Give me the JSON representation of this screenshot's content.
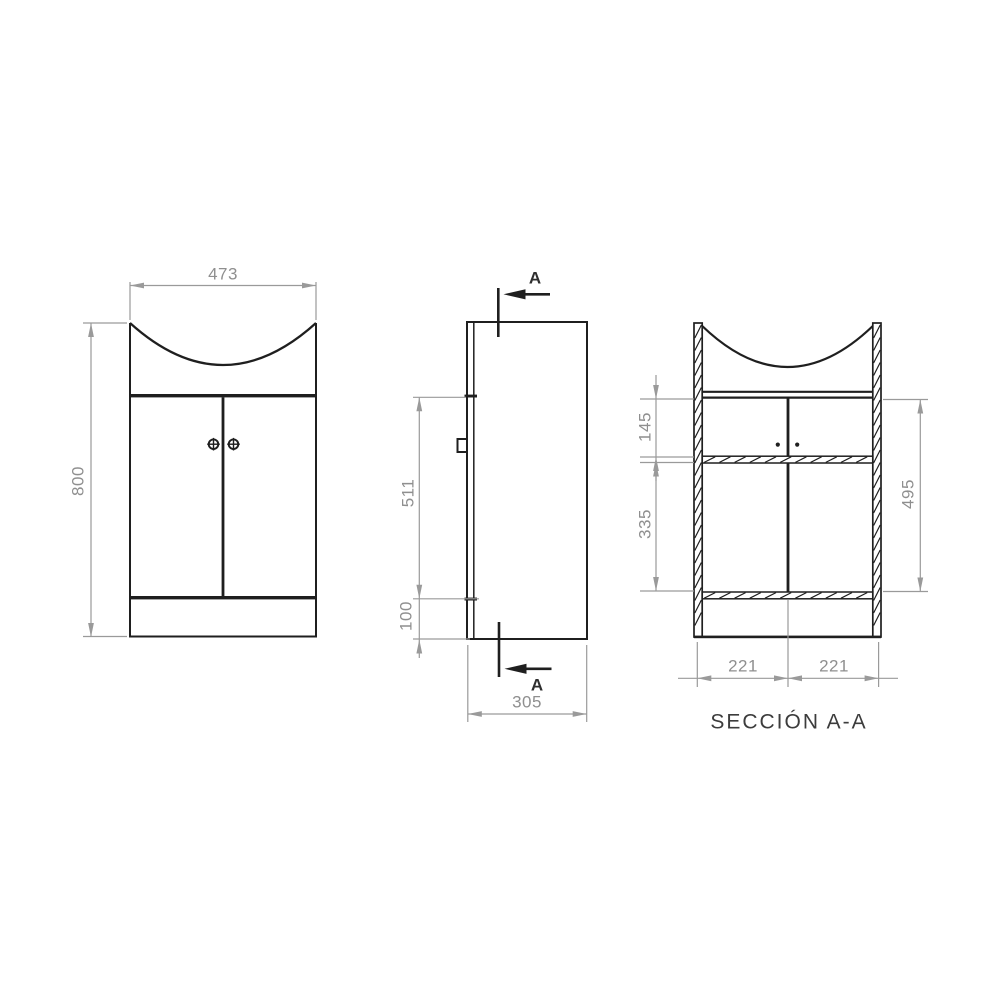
{
  "drawing": {
    "title": "SECCIÓN A-A",
    "section_marker_top": "A",
    "section_marker_bottom": "A",
    "front_view": {
      "width_mm": "473",
      "height_mm": "800"
    },
    "side_view": {
      "door_height_mm": "511",
      "plinth_height_mm": "100",
      "depth_mm": "305"
    },
    "section_view": {
      "upper_compartment_mm": "145",
      "lower_compartment_mm": "335",
      "interior_height_mm": "495",
      "left_half_width_mm": "221",
      "right_half_width_mm": "221"
    }
  },
  "colors": {
    "line_black": "#1f1f1f",
    "dimension_gray": "#9a9a9a",
    "text_gray": "#8f8f8f",
    "background": "#ffffff"
  }
}
